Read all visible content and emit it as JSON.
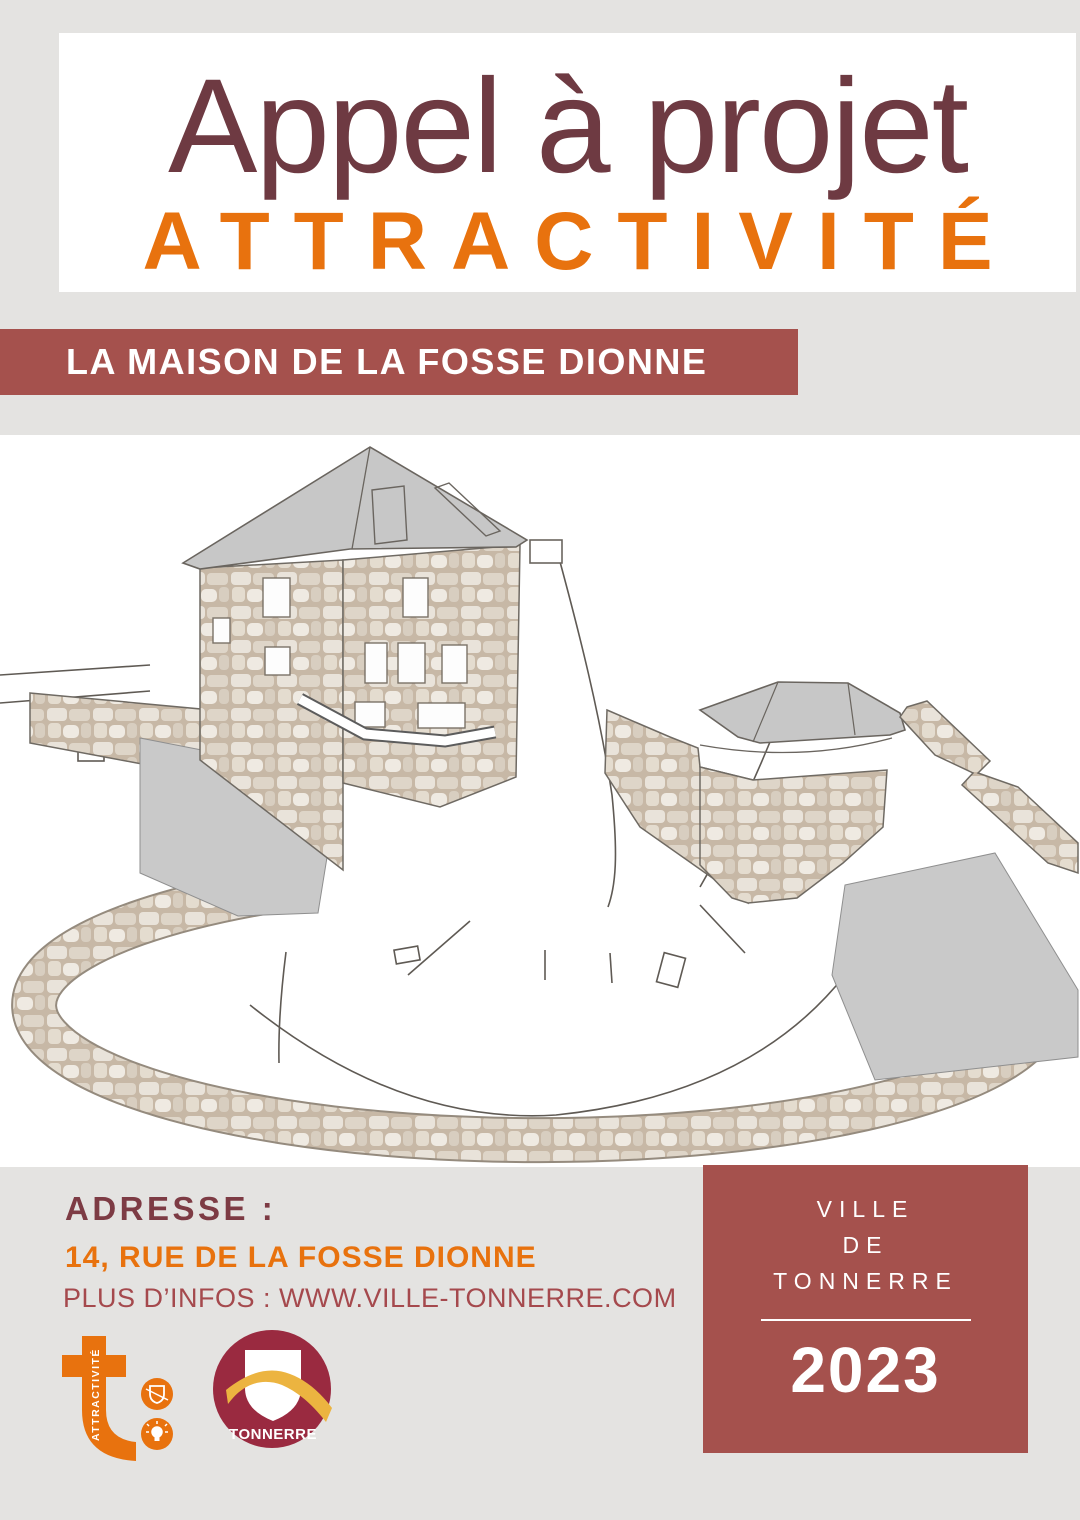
{
  "header": {
    "title_line1": "Appel à projet",
    "title_line2": "ATTRACTIVITÉ"
  },
  "banner": {
    "label": "LA MAISON DE LA FOSSE DIONNE"
  },
  "illustration": {
    "description": "hand-drawn architectural sketch of the Fosse Dionne house, pavilion and circular stone basin wall"
  },
  "footer": {
    "address_label": "ADRESSE :",
    "address_value": "14, RUE DE LA FOSSE DIONNE",
    "infos": "PLUS D’INFOS : WWW.VILLE-TONNERRE.COM",
    "attractivite_logo_text": "ATTRACTIVITÉ",
    "tonnerre_logo_text": "TONNERRE",
    "city_box": {
      "line1": "VILLE",
      "line2": "DE",
      "line3": "TONNERRE",
      "year": "2023"
    }
  },
  "colors": {
    "title_maroon": "#6e3a42",
    "accent_orange": "#e8720e",
    "banner_brick": "#a5514d",
    "logo_crimson": "#9a2a40",
    "logo_gold": "#ecb440",
    "background_gray": "#e4e3e1",
    "sketch_gray": "#c7c7c7"
  }
}
